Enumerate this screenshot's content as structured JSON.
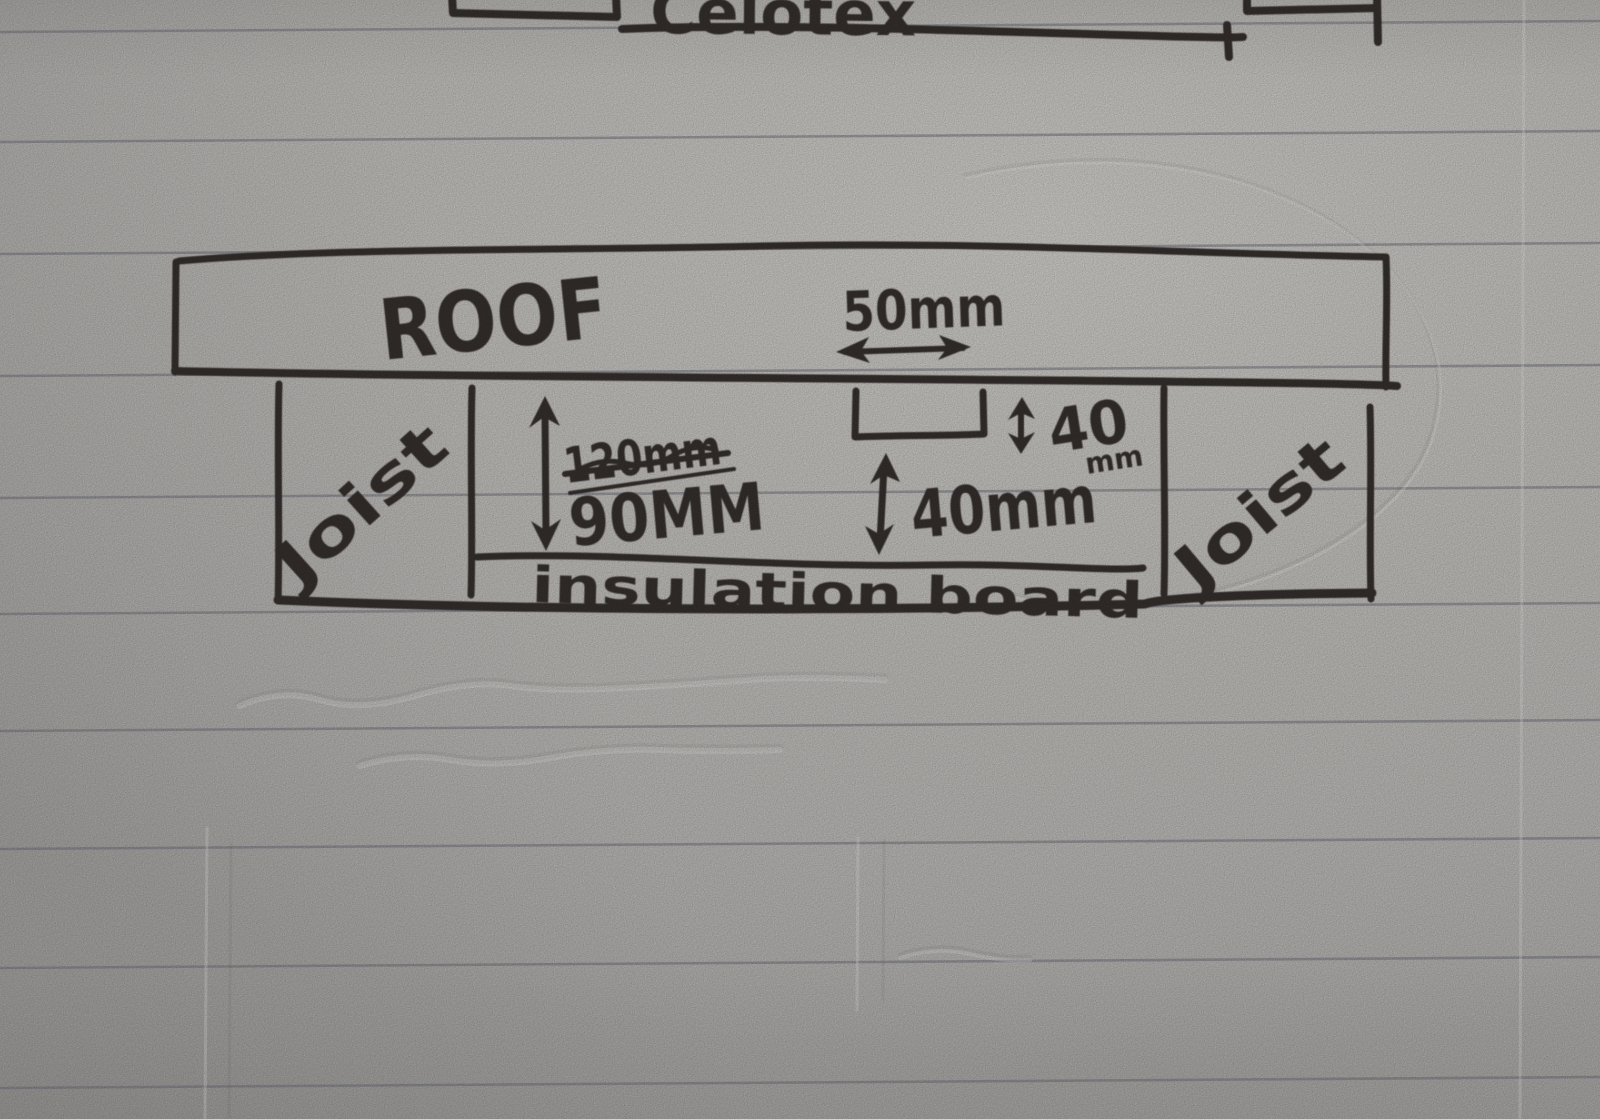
{
  "colors": {
    "ink": "#3a3433",
    "paper": "#d8d6d2",
    "rule": "#80808a"
  },
  "previous_sketch": {
    "product_label": "Celotex"
  },
  "roof": {
    "label": "ROOF",
    "batten_width": "50mm",
    "batten_thickness": "40",
    "batten_thickness_unit": "mm"
  },
  "cavity": {
    "old_depth_crossed_out": "120mm",
    "depth": "90MM",
    "batten_gap": "40mm"
  },
  "joists": {
    "left": "Joist",
    "right": "Joist"
  },
  "insulation": {
    "label": "insulation board"
  }
}
